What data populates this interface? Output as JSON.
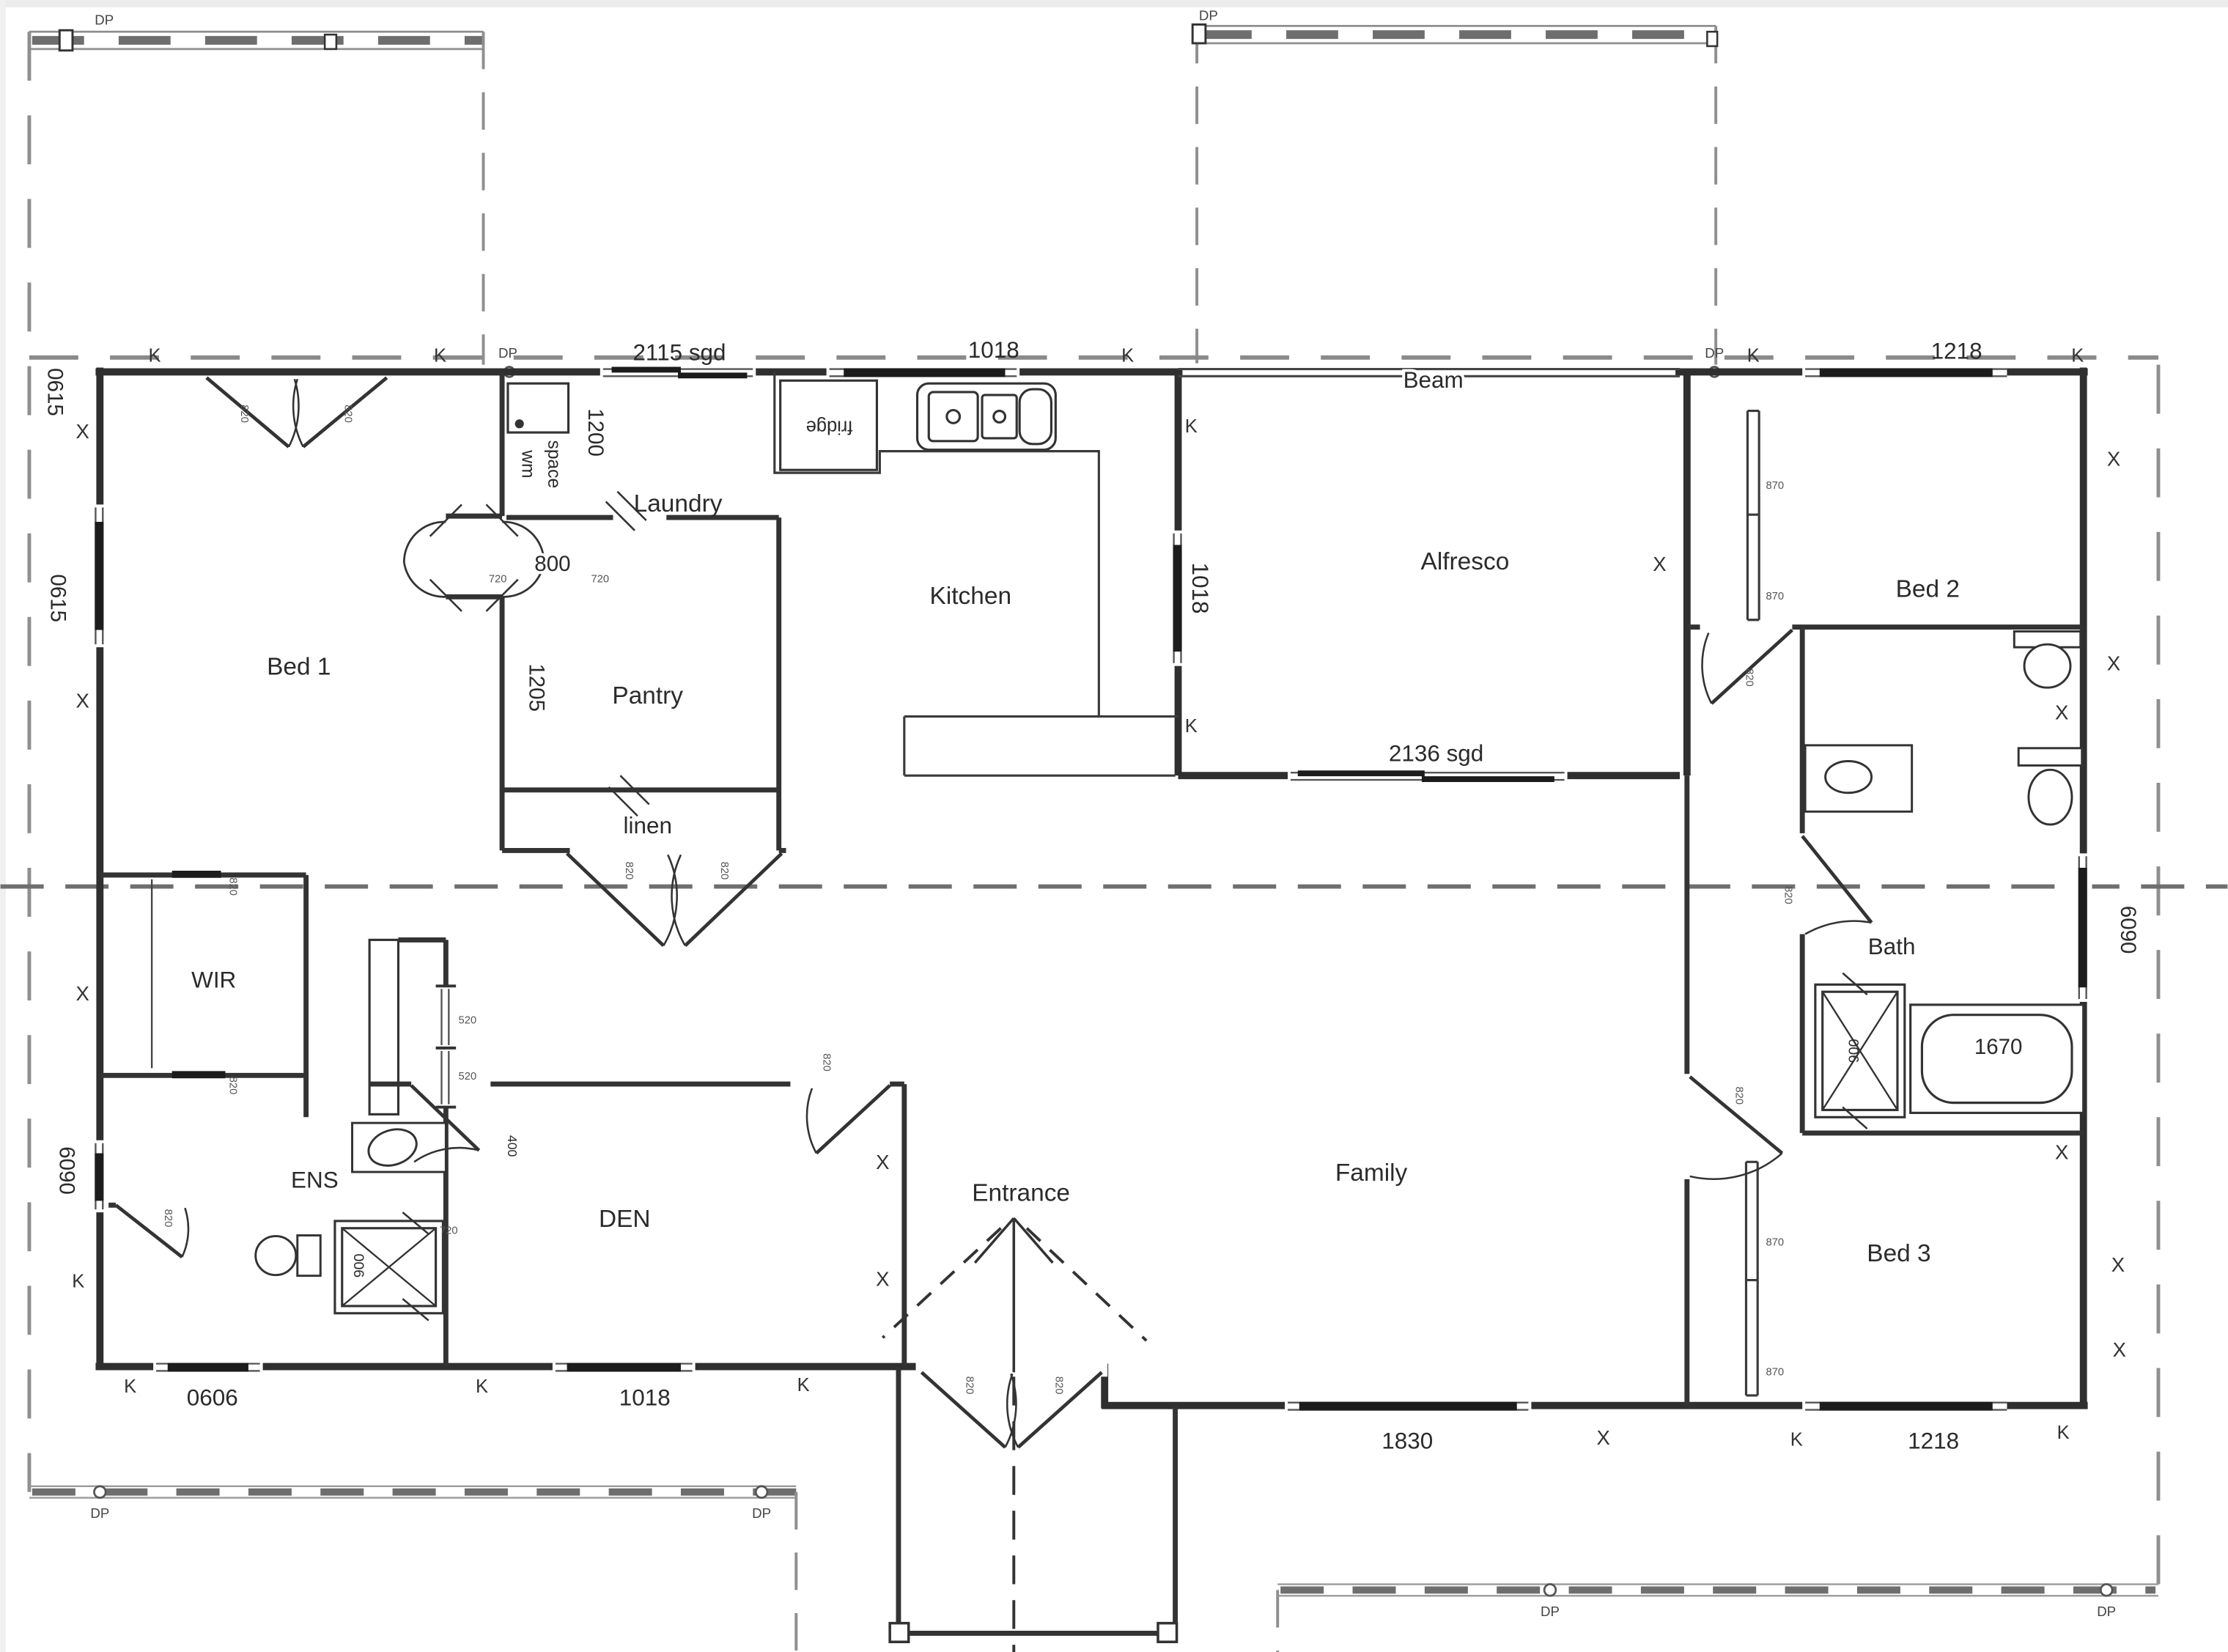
{
  "plan_title": "Residential floor plan",
  "rooms": {
    "bed1": "Bed 1",
    "bed2": "Bed 2",
    "bed3": "Bed 3",
    "kitchen": "Kitchen",
    "pantry": "Pantry",
    "linen": "linen",
    "laundry": "Laundry",
    "alfresco": "Alfresco",
    "bath": "Bath",
    "wir": "WIR",
    "ens": "ENS",
    "den": "DEN",
    "entrance": "Entrance",
    "family": "Family",
    "beam": "Beam"
  },
  "fixtures": {
    "fridge": "fridge",
    "wm_line1": "wm",
    "wm_line2": "space"
  },
  "dims": {
    "d2115sgd": "2115 sgd",
    "d1018": "1018",
    "d1218": "1218",
    "d2136sgd": "2136 sgd",
    "d800": "800",
    "d1670": "1670",
    "d0606": "0606",
    "d1830": "1830",
    "d0615": "0615",
    "d1200": "1200",
    "d1205": "1205",
    "d6090": "6090",
    "d900": "900",
    "d820": "820",
    "d870": "870",
    "d520": "520",
    "d720": "720",
    "d400": "400"
  },
  "marks": {
    "k": "K",
    "x": "X",
    "dp": "DP"
  }
}
